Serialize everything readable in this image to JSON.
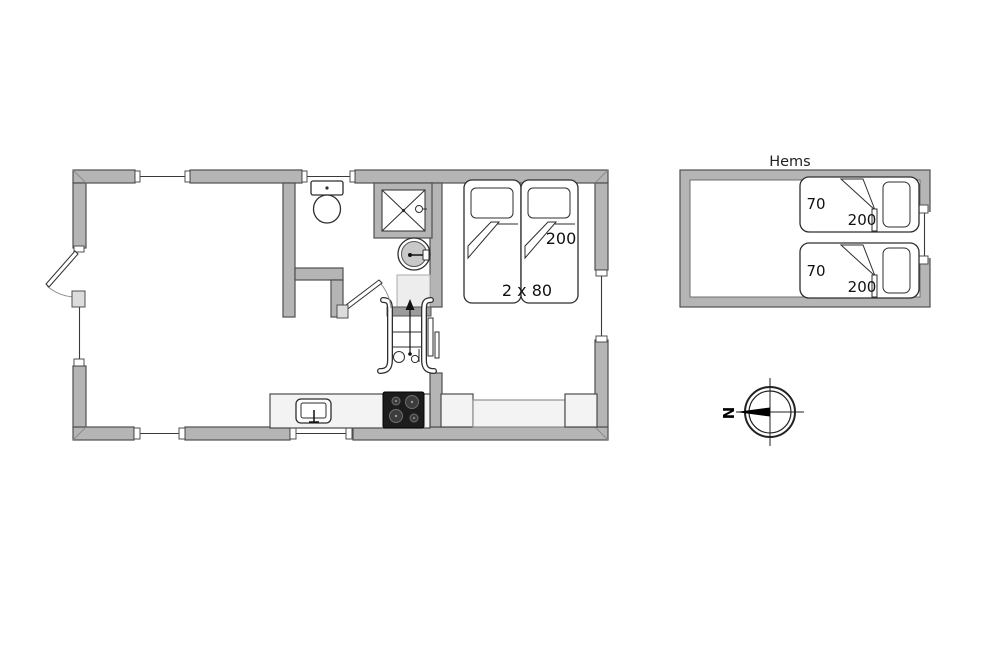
{
  "figure": {
    "type": "floorplan",
    "background": "#ffffff"
  },
  "colors": {
    "wall_fill": "#b5b5b5",
    "wall_outline": "#4f4f4f",
    "fixture_outline": "#2e2e2e",
    "furniture_fill": "#f3f3f3",
    "stove_fill": "#1c1c1c"
  },
  "main_floor": {
    "bedroom": {
      "bed_length": "200",
      "bed_size": "2 x 80"
    }
  },
  "hems": {
    "title": "Hems",
    "beds": [
      {
        "width": "70",
        "length": "200"
      },
      {
        "width": "70",
        "length": "200"
      }
    ]
  },
  "compass": {
    "north": "N"
  }
}
